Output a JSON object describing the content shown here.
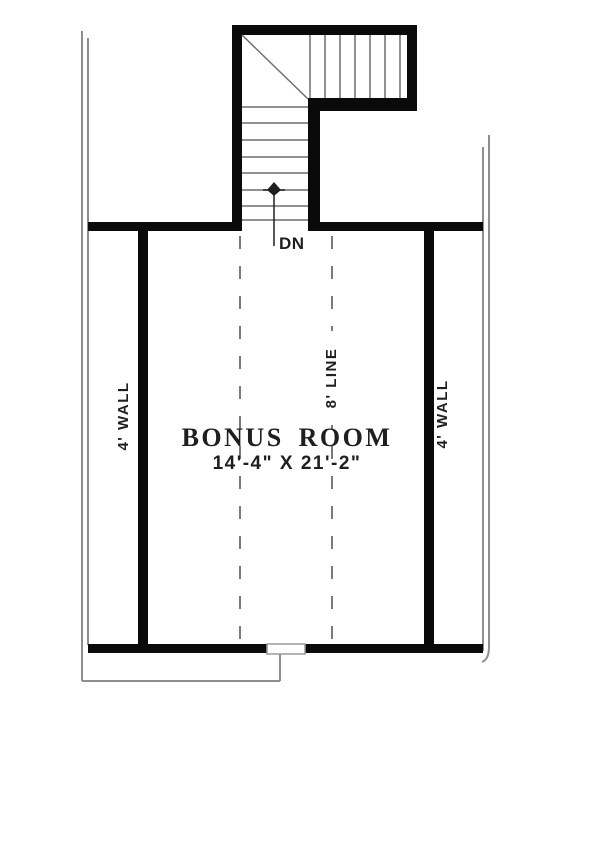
{
  "room": {
    "name": "BONUS ROOM",
    "dimensions": "14'-4\" X 21'-2\""
  },
  "labels": {
    "stair_direction": "DN",
    "left_wall": "4' WALL",
    "right_wall": "4' WALL",
    "ceiling_height_line": "8' LINE"
  },
  "colors": {
    "wall": "#0a0a0a",
    "thin_line": "#8e8e8e",
    "tread_line": "#6e6e6e",
    "dashed_line": "#7a7a7a",
    "text": "#1f1f1f",
    "background": "#ffffff",
    "window_fill": "#ffffff",
    "window_stroke": "#9a9a9a"
  }
}
